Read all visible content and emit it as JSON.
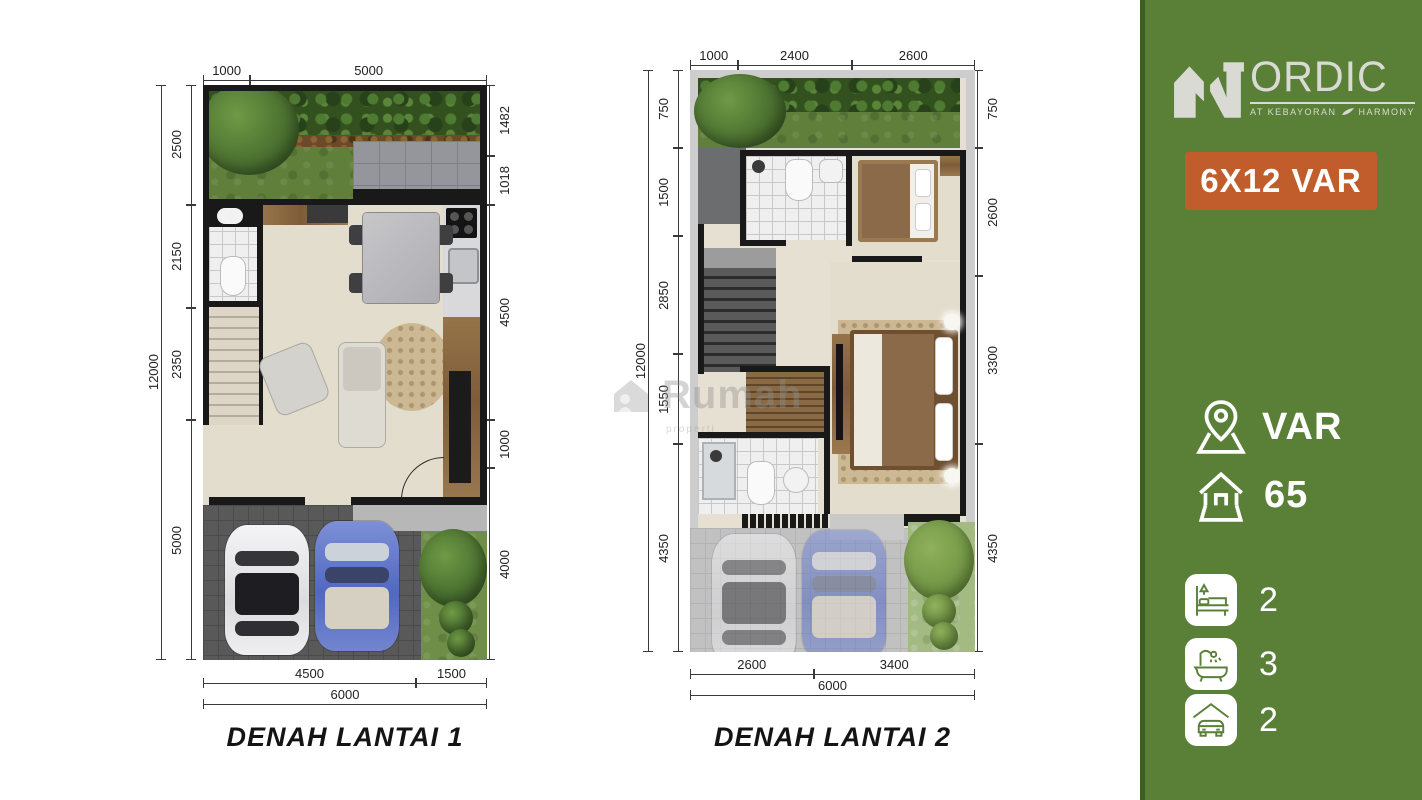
{
  "page": {
    "background": "#ffffff"
  },
  "watermark": {
    "text": "Rumah",
    "subtext": "properti"
  },
  "plans": [
    {
      "title": "DENAH LANTAI 1",
      "dims": {
        "top": [
          "1000",
          "5000"
        ],
        "left_total": "12000",
        "left": [
          "2500",
          "2150",
          "2350",
          "5000"
        ],
        "right": [
          "1482",
          "1018",
          "4500",
          "1000",
          "4000"
        ],
        "bottom": [
          "4500",
          "1500"
        ],
        "bottom_total": "6000"
      }
    },
    {
      "title": "DENAH LANTAI 2",
      "dims": {
        "top": [
          "1000",
          "2400",
          "2600"
        ],
        "left_total": "12000",
        "left": [
          "750",
          "1500",
          "2850",
          "1550",
          "4350"
        ],
        "right": [
          "750",
          "2600",
          "3300",
          "4350"
        ],
        "bottom": [
          "2600",
          "3400"
        ],
        "bottom_total": "6000"
      }
    }
  ],
  "sidebar": {
    "colors": {
      "background": "#5a8038",
      "stripe": "#3c5e25",
      "badge": "#c15d2c",
      "logo": "#d9dad4"
    },
    "logo": {
      "brand": "NORDIC",
      "brand_text": "ORDIC",
      "tagline_left": "AT KEBAYORAN",
      "tagline_right": "HARMONY"
    },
    "badge_label": "6X12 VAR",
    "stats": [
      {
        "icon": "location-pin-icon",
        "value": "VAR"
      },
      {
        "icon": "house-icon",
        "value": "65"
      }
    ],
    "features": [
      {
        "icon": "bed-icon",
        "value": "2"
      },
      {
        "icon": "bath-icon",
        "value": "3"
      },
      {
        "icon": "car-icon",
        "value": "2"
      }
    ]
  }
}
